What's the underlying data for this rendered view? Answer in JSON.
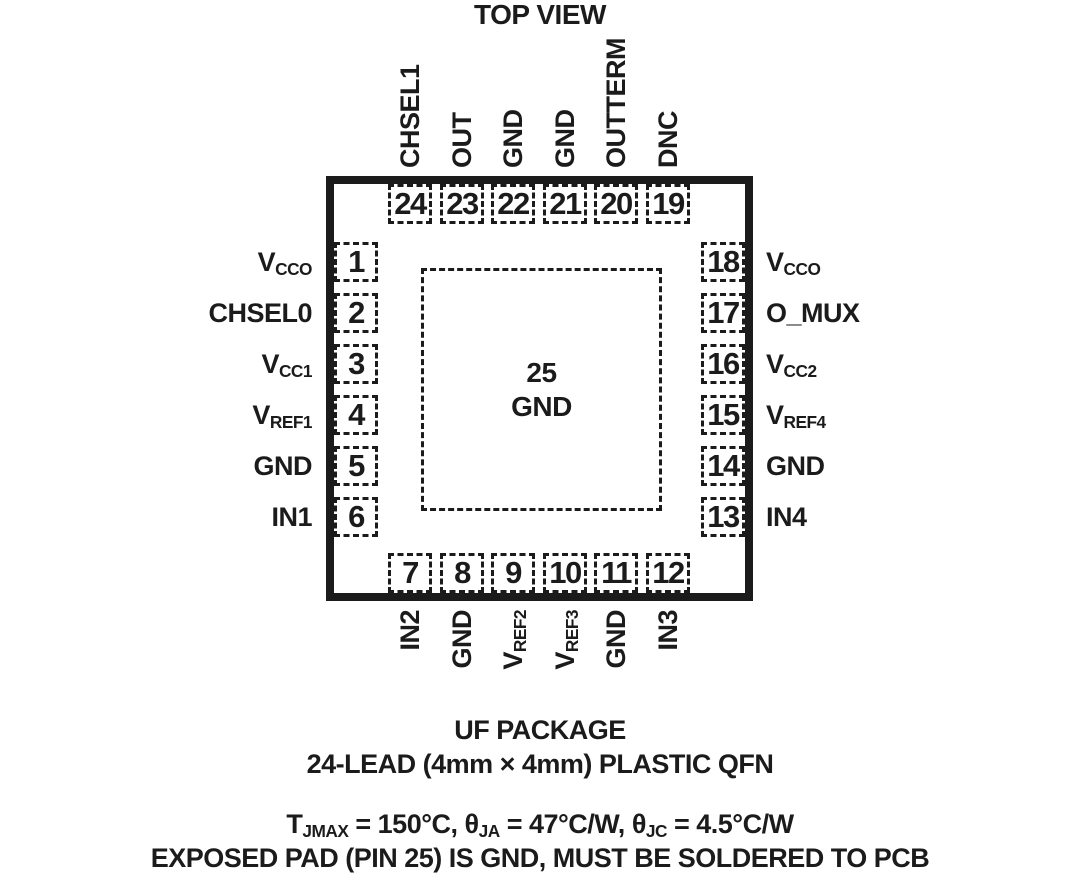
{
  "colors": {
    "ink": "#1b1b1b",
    "background": "#ffffff"
  },
  "title": "TOP VIEW",
  "package": {
    "center_pad": {
      "number": "25",
      "label": "GND"
    },
    "pins": {
      "top": [
        {
          "num": "24",
          "label": {
            "base": "CHSEL1",
            "sub": ""
          }
        },
        {
          "num": "23",
          "label": {
            "base": "OUT",
            "sub": ""
          }
        },
        {
          "num": "22",
          "label": {
            "base": "GND",
            "sub": ""
          }
        },
        {
          "num": "21",
          "label": {
            "base": "GND",
            "sub": ""
          }
        },
        {
          "num": "20",
          "label": {
            "base": "OUTTERM",
            "sub": ""
          }
        },
        {
          "num": "19",
          "label": {
            "base": "DNC",
            "sub": ""
          }
        }
      ],
      "left": [
        {
          "num": "1",
          "label": {
            "base": "V",
            "sub": "CCO"
          }
        },
        {
          "num": "2",
          "label": {
            "base": "CHSEL0",
            "sub": ""
          }
        },
        {
          "num": "3",
          "label": {
            "base": "V",
            "sub": "CC1"
          }
        },
        {
          "num": "4",
          "label": {
            "base": "V",
            "sub": "REF1"
          }
        },
        {
          "num": "5",
          "label": {
            "base": "GND",
            "sub": ""
          }
        },
        {
          "num": "6",
          "label": {
            "base": "IN1",
            "sub": ""
          }
        }
      ],
      "right": [
        {
          "num": "18",
          "label": {
            "base": "V",
            "sub": "CCO"
          }
        },
        {
          "num": "17",
          "label": {
            "base": "O_MUX",
            "sub": ""
          }
        },
        {
          "num": "16",
          "label": {
            "base": "V",
            "sub": "CC2"
          }
        },
        {
          "num": "15",
          "label": {
            "base": "V",
            "sub": "REF4"
          }
        },
        {
          "num": "14",
          "label": {
            "base": "GND",
            "sub": ""
          }
        },
        {
          "num": "13",
          "label": {
            "base": "IN4",
            "sub": ""
          }
        }
      ],
      "bottom": [
        {
          "num": "7",
          "label": {
            "base": "IN2",
            "sub": ""
          }
        },
        {
          "num": "8",
          "label": {
            "base": "GND",
            "sub": ""
          }
        },
        {
          "num": "9",
          "label": {
            "base": "V",
            "sub": "REF2"
          }
        },
        {
          "num": "10",
          "label": {
            "base": "V",
            "sub": "REF3"
          }
        },
        {
          "num": "11",
          "label": {
            "base": "GND",
            "sub": ""
          }
        },
        {
          "num": "12",
          "label": {
            "base": "IN3",
            "sub": ""
          }
        }
      ]
    }
  },
  "caption": {
    "package_name": "UF PACKAGE",
    "package_desc": "24-LEAD (4mm × 4mm) PLASTIC QFN",
    "thermal": {
      "t_base": "T",
      "t_sub": "JMAX",
      "seg_a": " = 150°C, ",
      "theta1_base": "θ",
      "theta1_sub": "JA",
      "seg_b": " = 47°C/W, ",
      "theta2_base": "θ",
      "theta2_sub": "JC",
      "seg_c": " = 4.5°C/W"
    },
    "note": "EXPOSED PAD (PIN 25) IS GND, MUST BE SOLDERED TO PCB"
  }
}
